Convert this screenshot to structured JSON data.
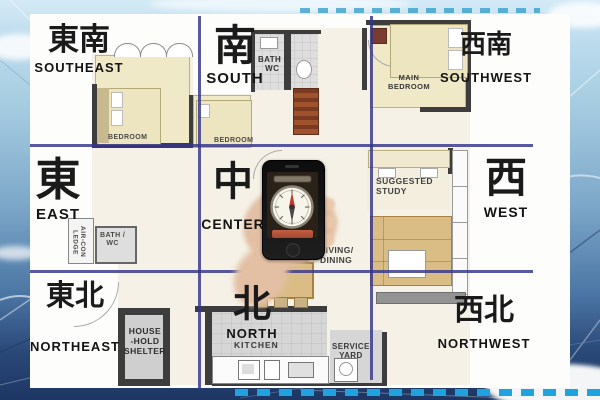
{
  "compass": {
    "grid_line_color": "#34348c",
    "directions": [
      {
        "id": "southeast",
        "zh": "東南",
        "en": "SOUTHEAST"
      },
      {
        "id": "south",
        "zh": "南",
        "en": "SOUTH"
      },
      {
        "id": "southwest",
        "zh": "西南",
        "en": "SOUTHWEST"
      },
      {
        "id": "east",
        "zh": "東",
        "en": "EAST"
      },
      {
        "id": "center",
        "zh": "中",
        "en": "CENTER"
      },
      {
        "id": "west",
        "zh": "西",
        "en": "WEST"
      },
      {
        "id": "northeast",
        "zh": "東北",
        "en": "NORTHEAST"
      },
      {
        "id": "north",
        "zh": "北",
        "en": "NORTH"
      },
      {
        "id": "northwest",
        "zh": "西北",
        "en": "NORTHWEST"
      }
    ]
  },
  "floor_plan": {
    "labels": {
      "bedroom1": "BEDROOM",
      "bedroom2": "BEDROOM",
      "bath_upper": "BATH /\nWC",
      "main_bedroom": "MAIN\nBEDROOM",
      "study": "SUGGESTED\nSTUDY",
      "living_dining": "LIVING/\nDINING",
      "aircon_ledge": "AIR-CON\nLEDGE",
      "bath_lower": "BATH /\nWC",
      "kitchen": "KITCHEN",
      "service_yard": "SERVICE\nYARD",
      "household_shelter": "HOUSE\n-HOLD\nSHELTER"
    },
    "colors": {
      "wall": "#3d3d3d",
      "bedroom_floor": "#efe9c8",
      "bath_floor": "#dedede",
      "kitchen_floor": "#d6d6d6",
      "living_floor": "#f5f1e6",
      "furniture_tan": "#d9bd85"
    }
  },
  "phone": {
    "colors": {
      "body": "#141414",
      "screen": "#2a2119",
      "dial_face": "#f7f4ea",
      "needle_north": "#c0392b",
      "banner": "#b5543c"
    }
  }
}
